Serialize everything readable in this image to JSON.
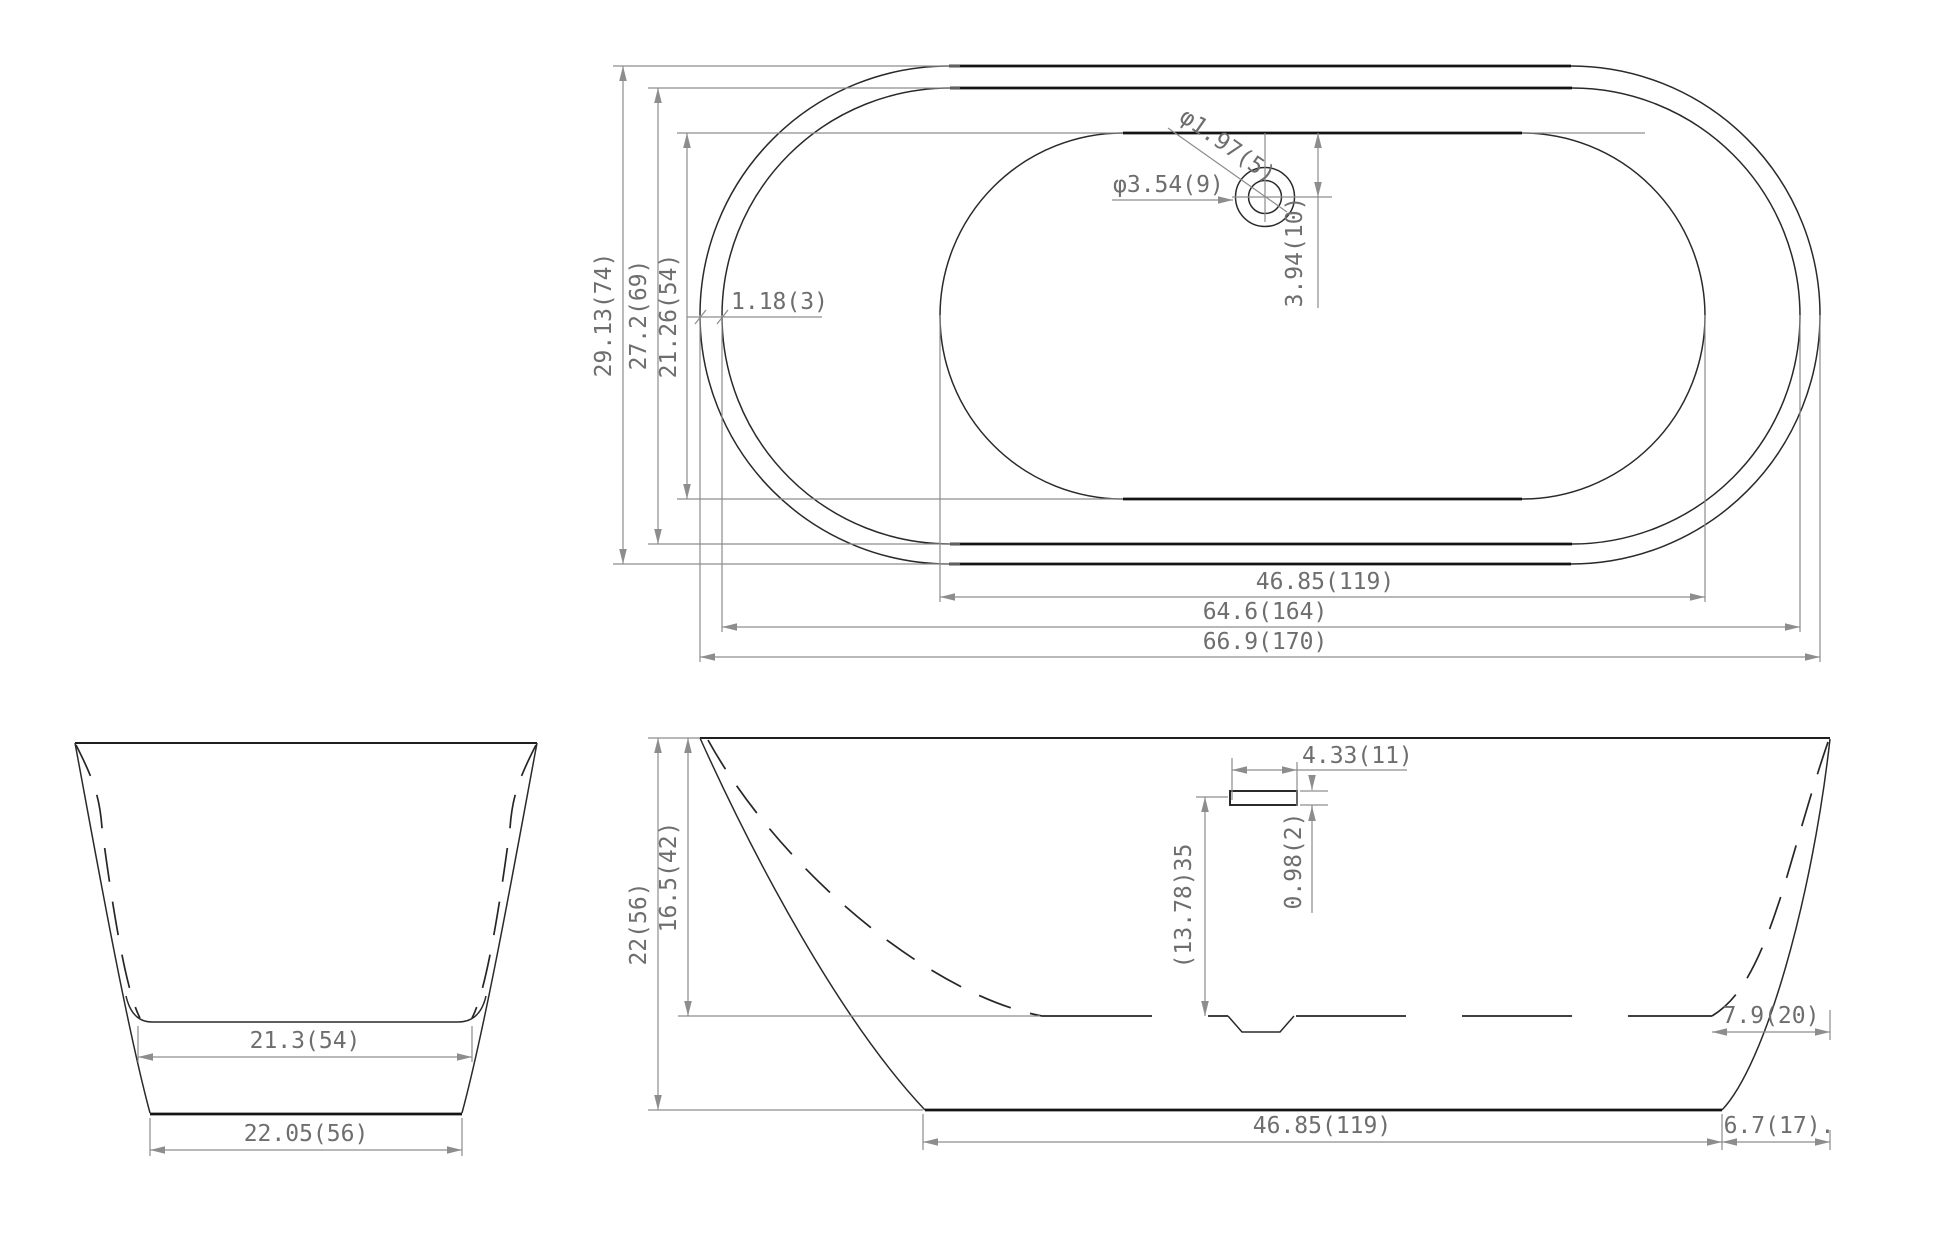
{
  "drawing": {
    "kind": "bathtub technical dimension drawing",
    "background_color": "#ffffff",
    "line_color": "#2a2a2a",
    "dimension_color": "#8d8d8d",
    "text_color": "#6e6e6e"
  },
  "top_view": {
    "overall_width": "29.13(74)",
    "inner_rim_width": "27.2(69)",
    "basin_width": "21.26(54)",
    "rim_thickness": "1.18(3)",
    "drain_hole_diameter": "φ1.97(5)",
    "drain_flange_diameter": "φ3.54(9)",
    "drain_center_offset": "3.94(10)",
    "basin_length": "46.85(119)",
    "inner_rim_length": "64.6(164)",
    "overall_length": "66.9(170)"
  },
  "end_view": {
    "floor_width": "21.3(54)",
    "base_width": "22.05(56)"
  },
  "side_view": {
    "overall_height": "22(56)",
    "interior_depth": "16.5(42)",
    "overflow_length": "4.33(11)",
    "overflow_height": "0.98(2)",
    "overflow_above_floor": "(13.78)35",
    "floor_end_offset": "7.9(20)",
    "base_length": "46.85(119)",
    "base_end_offset": "6.7(17)."
  }
}
